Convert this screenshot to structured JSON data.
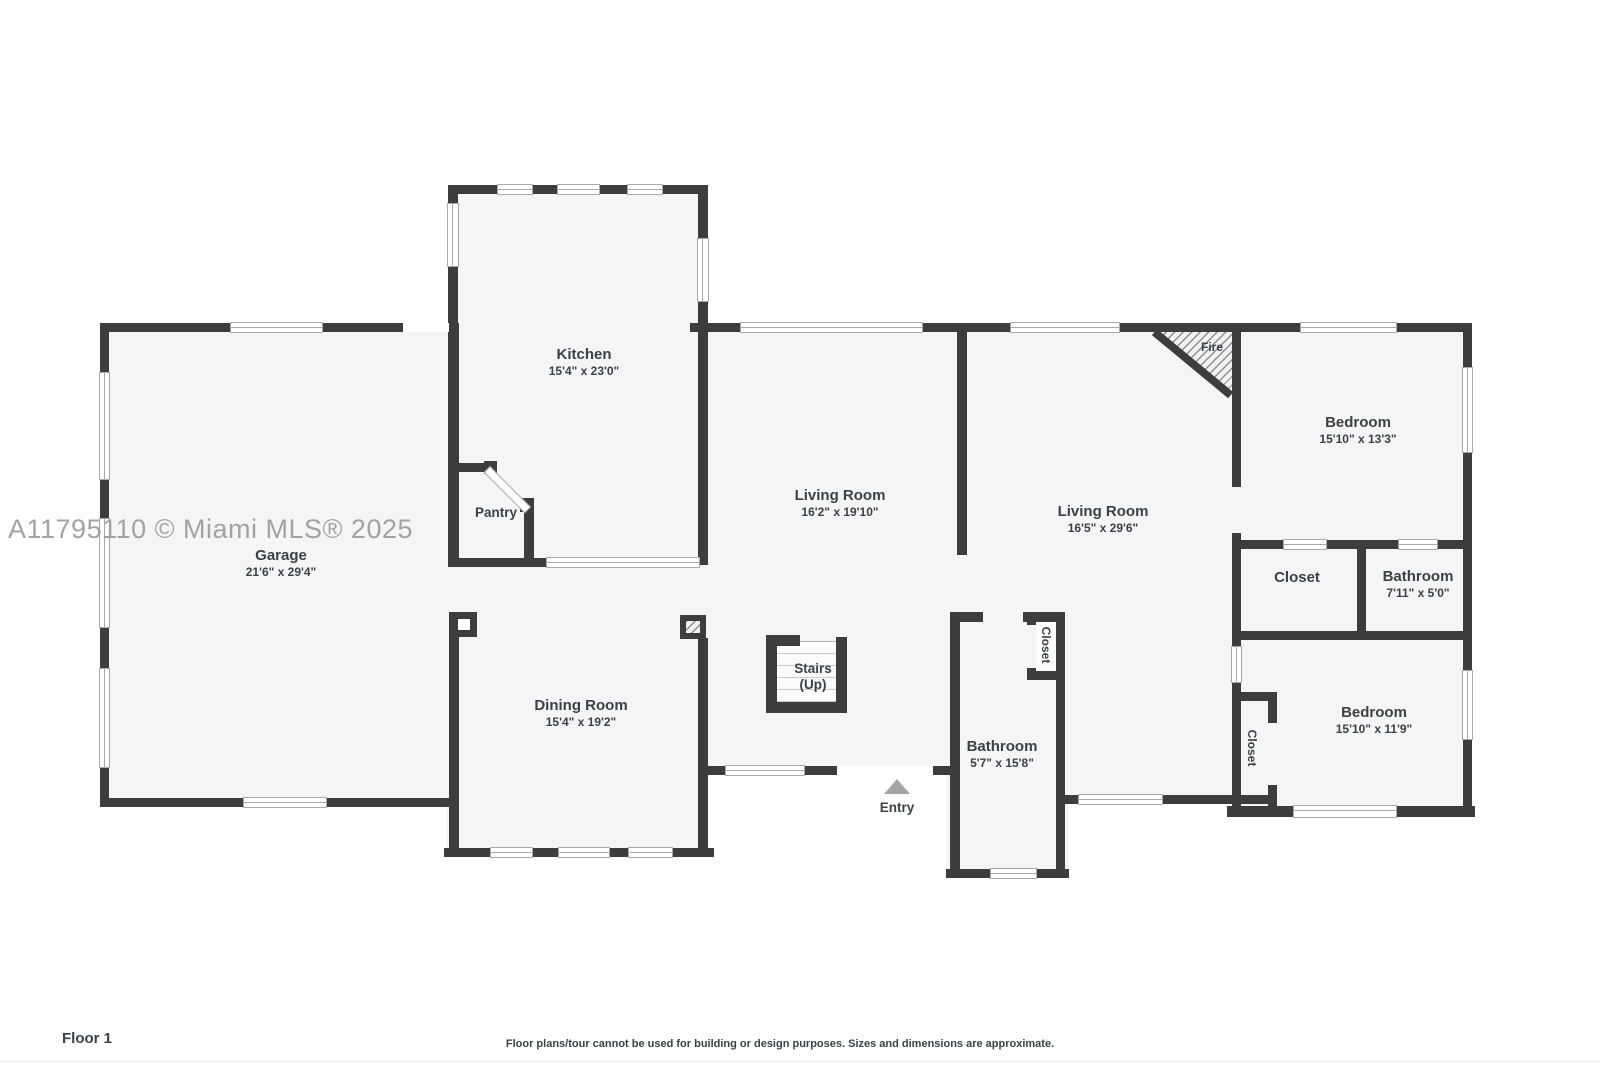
{
  "watermark": "A11795110 © Miami MLS® 2025",
  "footer": {
    "floor_label": "Floor 1",
    "disclaimer": "Floor plans/tour cannot be used for building or design purposes. Sizes and dimensions are approximate."
  },
  "rooms": {
    "garage": {
      "name": "Garage",
      "dims": "21'6\" x 29'4\""
    },
    "kitchen": {
      "name": "Kitchen",
      "dims": "15'4\" x 23'0\""
    },
    "pantry": {
      "name": "Pantry"
    },
    "dining_room": {
      "name": "Dining Room",
      "dims": "15'4\" x 19'2\""
    },
    "living_room_1": {
      "name": "Living Room",
      "dims": "16'2\" x 19'10\""
    },
    "living_room_2": {
      "name": "Living Room",
      "dims": "16'5\" x 29'6\""
    },
    "bedroom_1": {
      "name": "Bedroom",
      "dims": "15'10\" x 13'3\""
    },
    "closet_1": {
      "name": "Closet"
    },
    "bathroom_1": {
      "name": "Bathroom",
      "dims": "7'11\" x 5'0\""
    },
    "bedroom_2": {
      "name": "Bedroom",
      "dims": "15'10\" x 11'9\""
    },
    "closet_2": {
      "name": "Closet"
    },
    "bathroom_2": {
      "name": "Bathroom",
      "dims": "5'7\" x 15'8\""
    },
    "closet_3": {
      "name": "Closet"
    },
    "stairs": {
      "name": "Stairs",
      "direction": "(Up)"
    },
    "entry": {
      "name": "Entry"
    },
    "fireplace": {
      "name": "Fire"
    }
  },
  "colors": {
    "wall": "#3d3d3d",
    "room_fill": "#f5f5f5",
    "watermark": "#9c9c9c"
  }
}
